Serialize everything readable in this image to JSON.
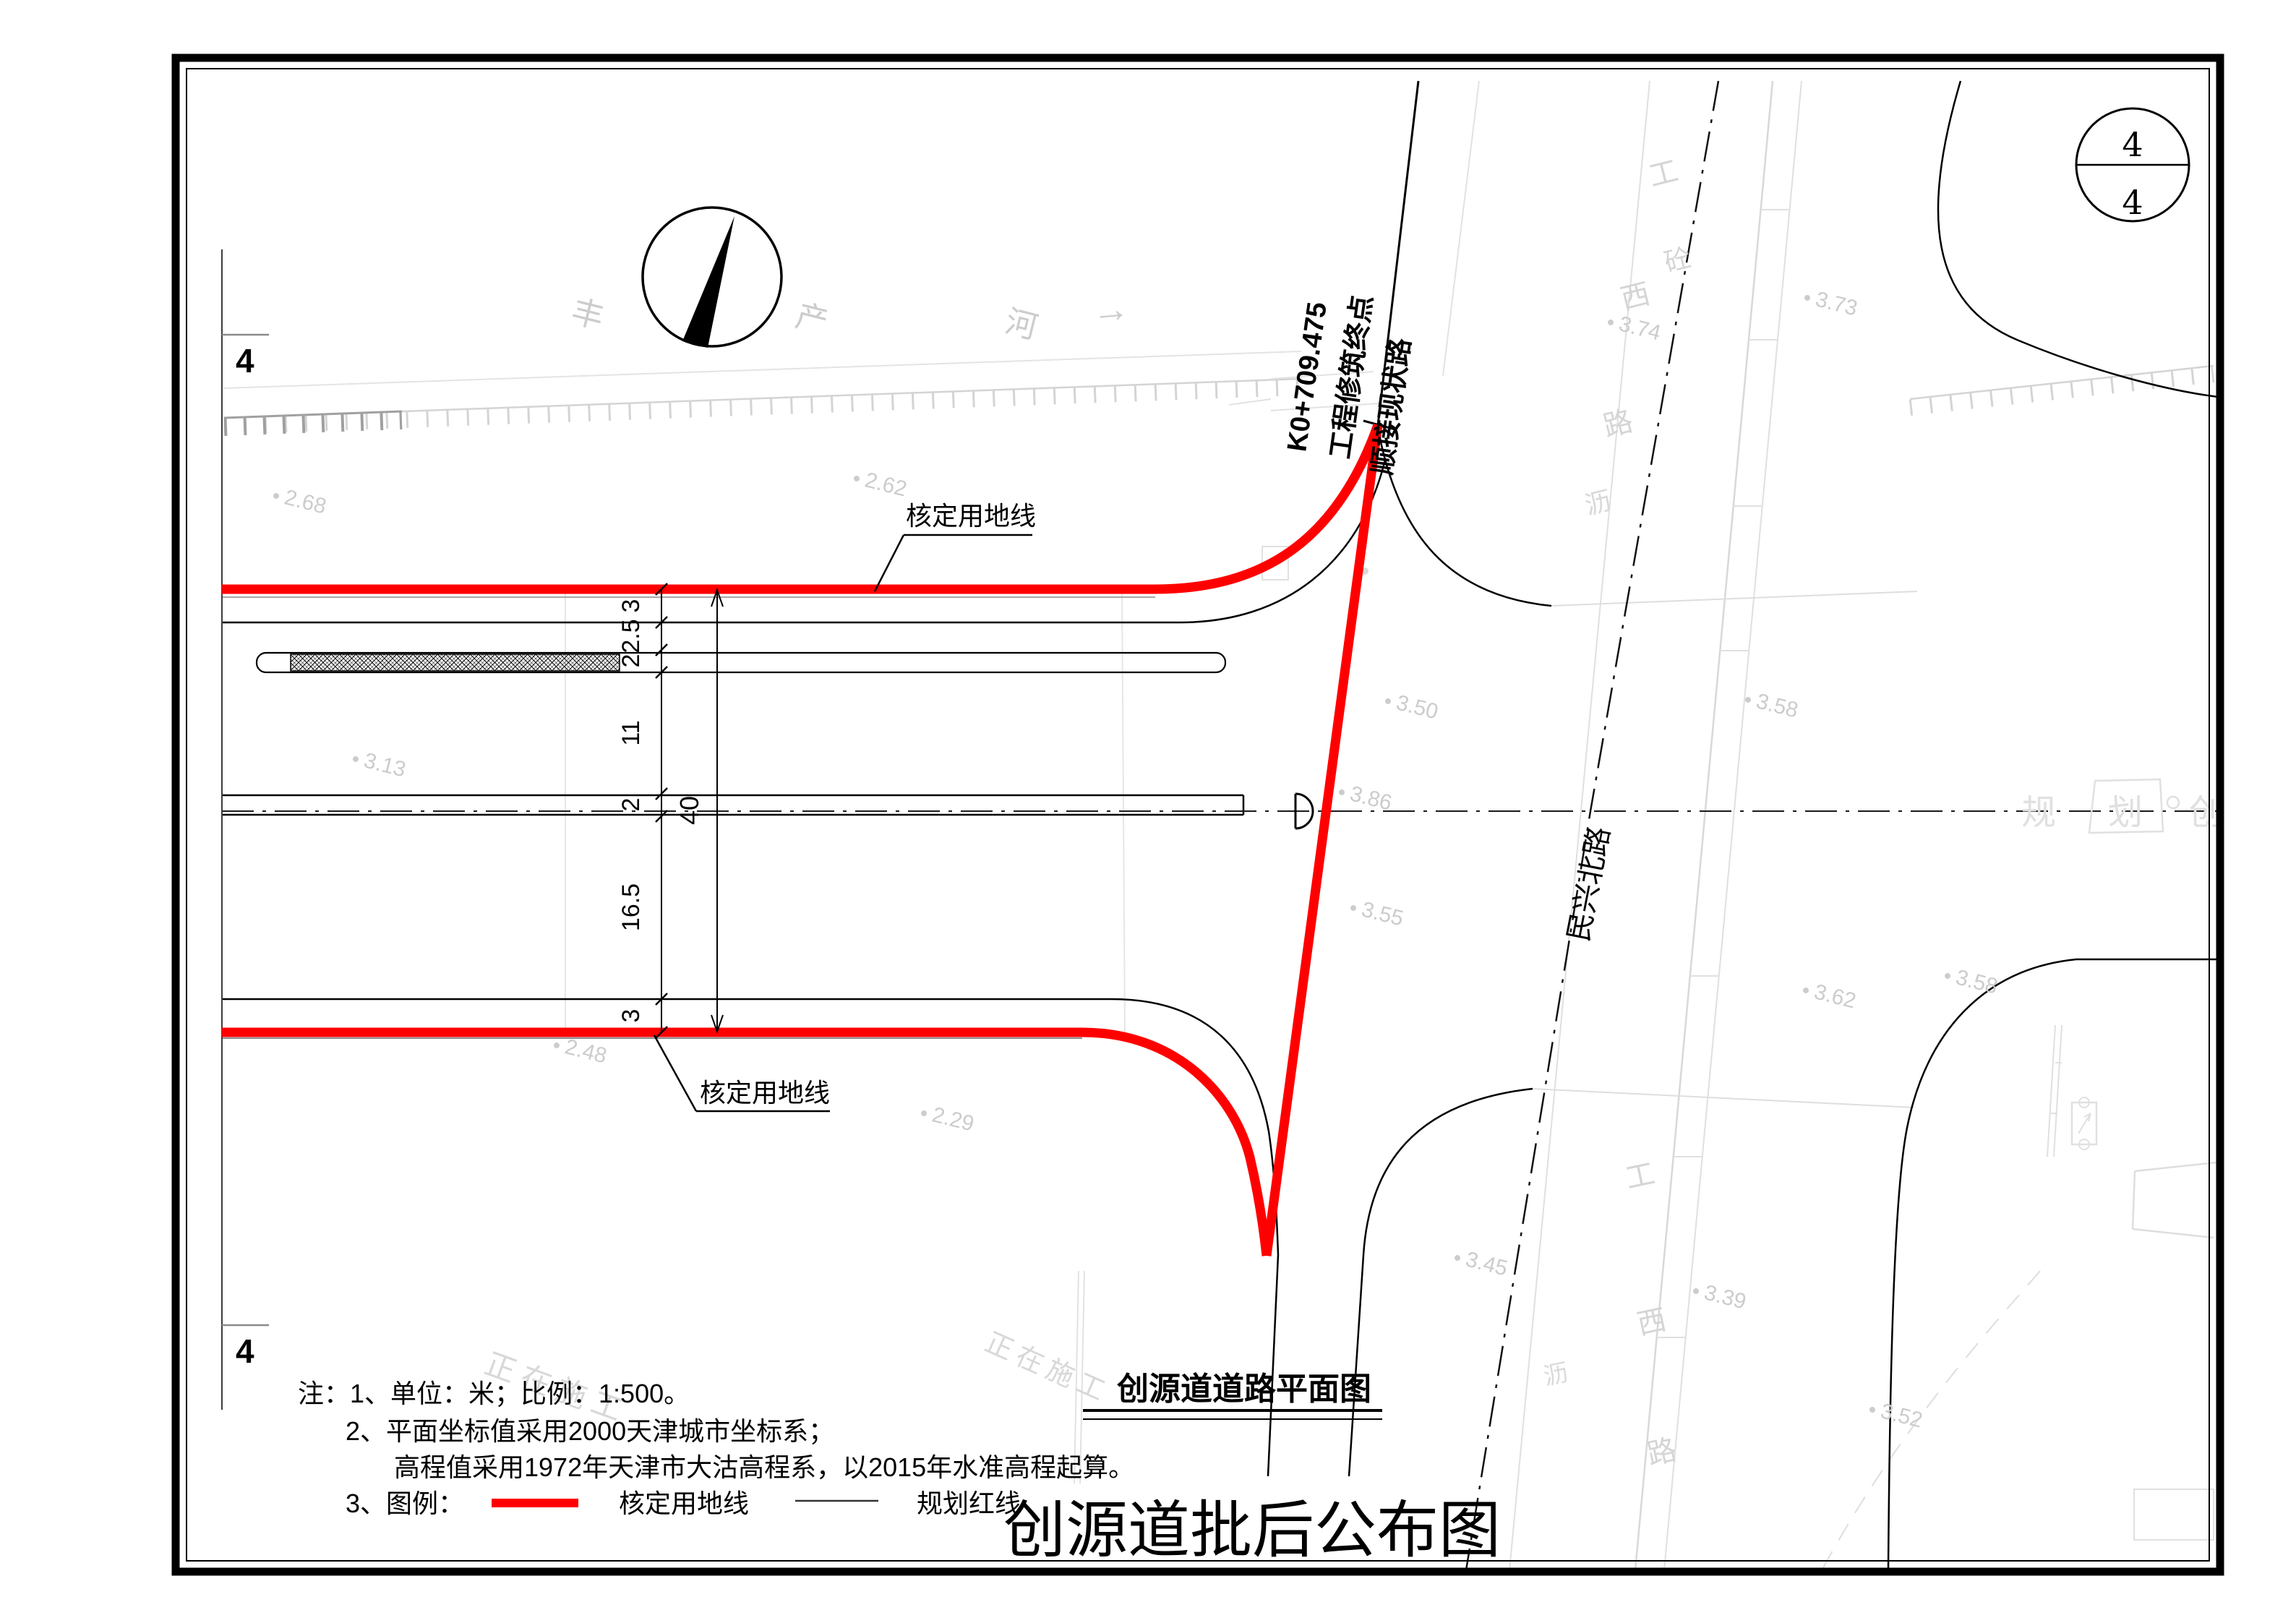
{
  "sheet": {
    "number_top": "4",
    "number_bottom": "4",
    "match_line_label": "4"
  },
  "titles": {
    "plan_title": "创源道道路平面图",
    "publication_title": "创源道批后公布图"
  },
  "notes": {
    "line1": "注：1、单位：米；比例：1:500。",
    "line2": "2、平面坐标值采用2000天津城市坐标系；",
    "line3": "高程值采用1972年天津市大沽高程系，以2015年水准高程起算。",
    "line4": "3、图例：",
    "legend_approved": "核定用地线",
    "legend_planning": "规划红线"
  },
  "labels": {
    "approved_top": "核定用地线",
    "approved_bottom": "核定用地线",
    "station": "K0+709.475",
    "endpoint": "工程修筑终点",
    "connect": "顺接现状路",
    "road_minxing": "民兴北路"
  },
  "dimensions": {
    "chain": [
      "3",
      "2.5",
      "2",
      "11",
      "2",
      "16.5",
      "3"
    ],
    "total": "40"
  },
  "background": {
    "river": [
      "丰",
      "产",
      "河"
    ],
    "river_arrow": "→",
    "road_top": [
      "工",
      "砼",
      "西",
      "路",
      "沥"
    ],
    "road_bottom": [
      "工",
      "西",
      "路",
      "沥"
    ],
    "planning_strip": [
      "规",
      "划",
      "创"
    ],
    "construction": "正在施工",
    "elevations": [
      "2.62",
      "2.68",
      "3.13",
      "2.48",
      "2.29",
      "3.50",
      "3.86",
      "3.55",
      "3.45",
      "3.58",
      "3.62",
      "3.39",
      "3.52",
      "3.73",
      "3.74",
      "3.58"
    ]
  },
  "colors": {
    "approved_line": "#FF0000",
    "planning_line": "#000000",
    "existing_features": "#D8D8D8"
  }
}
